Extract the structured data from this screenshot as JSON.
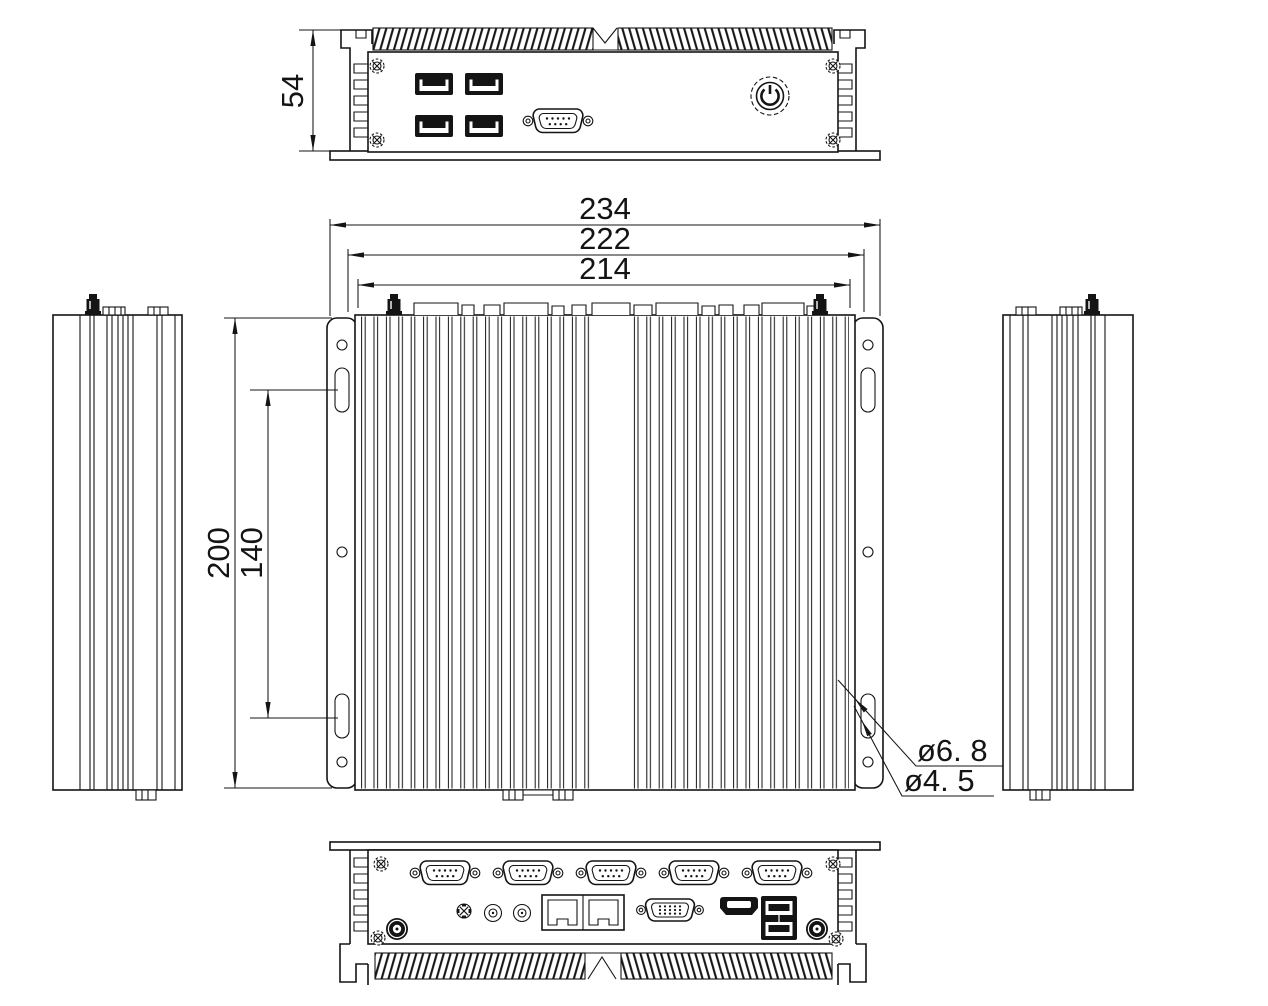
{
  "drawing": {
    "type": "mechanical-dimension-drawing",
    "subject": "fanless-embedded-box-pc",
    "colors": {
      "background": "#ffffff",
      "line": "#141414"
    },
    "dimensions": {
      "front_height": "54",
      "width_overall": "234",
      "width_outer": "222",
      "width_body": "214",
      "depth_body": "200",
      "mount_slot_spacing": "140",
      "mount_slot_dia": "ø6. 8",
      "mount_hole_dia": "ø4. 5"
    },
    "ports": {
      "front": [
        "usb-a-port-x4",
        "db9-serial-port",
        "power-button",
        "corner-screw-x4"
      ],
      "rear": [
        "db9-serial-port-x5",
        "antenna-connector-x2",
        "reset-button",
        "audio-jack-x2",
        "rj45-lan-port-x2",
        "vga-port",
        "hdmi-port",
        "usb-a-stacked-ports",
        "corner-screw-x2"
      ],
      "top": [
        "antenna-connector-x2",
        "mount-slot-x4",
        "mount-hole-x6"
      ]
    }
  }
}
